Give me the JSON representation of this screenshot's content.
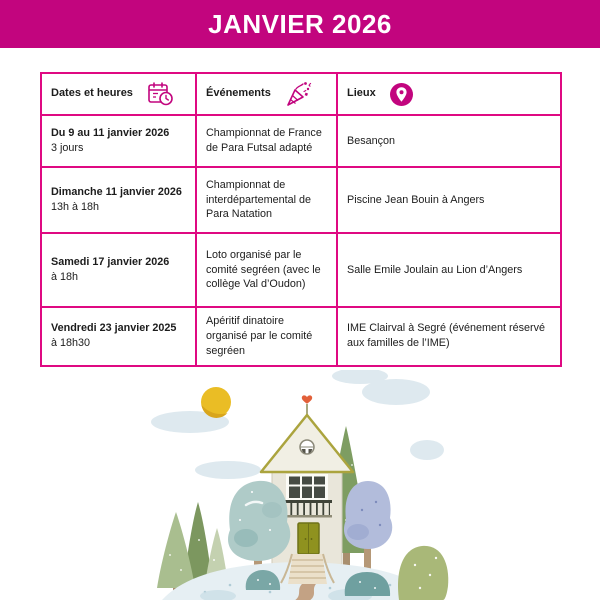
{
  "banner": {
    "title": "JANVIER 2026"
  },
  "colors": {
    "accent": "#C2057E",
    "table-border": "#DF0982",
    "banner-text": "#FFFFFF",
    "body-text": "#1C1C1C"
  },
  "table": {
    "columns": [
      {
        "label": "Dates et heures",
        "icon": "calendar-clock-icon"
      },
      {
        "label": "Événements",
        "icon": "party-popper-icon"
      },
      {
        "label": "Lieux",
        "icon": "location-pin-icon"
      }
    ],
    "rows": [
      {
        "date": "Du 9 au 11 janvier 2026",
        "time": "3 jours",
        "event": "Championnat de France de Para Futsal adapté",
        "place": "Besançon"
      },
      {
        "date": "Dimanche 11 janvier 2026",
        "time": "13h à 18h",
        "event": "Championnat de interdépartemental de Para Natation",
        "place": "Piscine Jean Bouin à Angers"
      },
      {
        "date": "Samedi 17 janvier 2026",
        "time": "à 18h",
        "event": "Loto organisé par le comité segréen (avec le collège Val d’Oudon)",
        "place": "Salle Emile Joulain au Lion d’Angers"
      },
      {
        "date": "Vendredi 23 janvier 2025",
        "time": "à 18h30",
        "event": "Apéritif dinatoire organisé par le comité segréen",
        "place": "IME Clairval à Segré (événement réservé aux familles de l’IME)"
      }
    ]
  },
  "illustration": {
    "description": "watercolor house on a hill with trees, sun and clouds",
    "sun_color": "#EABD25",
    "cloud_color": "#DEE9EF",
    "house_wall_color": "#E9E6DA",
    "roof_trim_color": "#ABA43E",
    "door_color": "#8F921F",
    "heart_color": "#E2603A",
    "teal_tree_color": "#AFCBC8",
    "blue_tree_color": "#B2BCDB",
    "green_tree_color": "#7C975F",
    "hill_color": "#E6EFF3",
    "path_color": "#C3A284"
  }
}
